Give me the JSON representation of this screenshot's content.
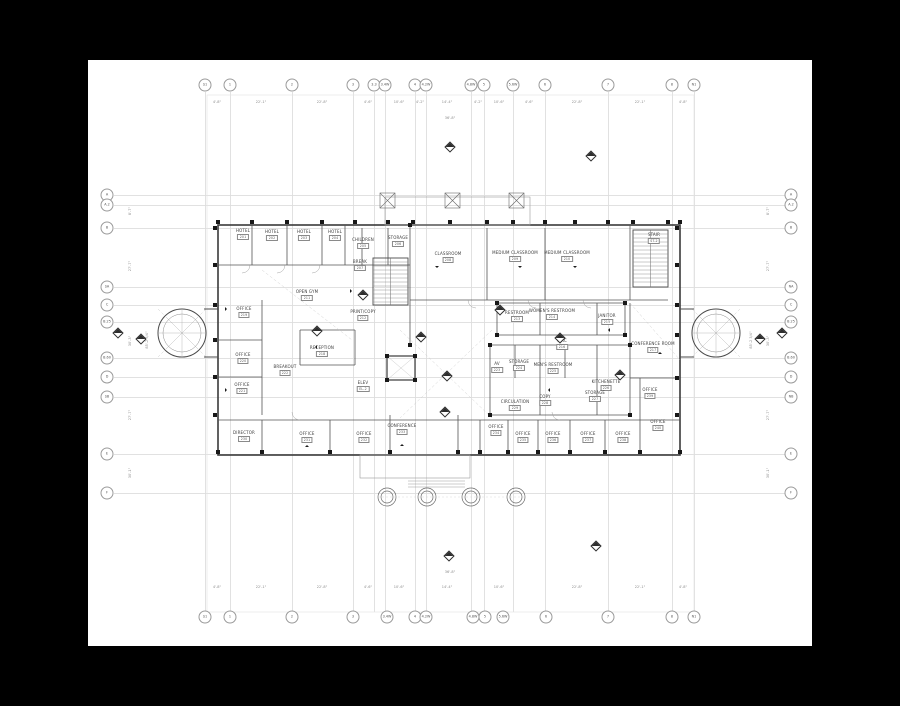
{
  "page": {
    "background": "#000000",
    "paper_color": "#ffffff",
    "paper": {
      "x": 88,
      "y": 60,
      "w": 724,
      "h": 586
    },
    "line_colors": {
      "grid": "#dcdcdc",
      "wall": "#3a3a3a",
      "partition": "#555555",
      "light": "#999999"
    },
    "drawing_type_note": "second floor plan"
  },
  "grid": {
    "top_y": 85,
    "bottom_y": 617,
    "left_x": 107,
    "right_x": 791,
    "vline_top": 92,
    "vline_bottom": 612,
    "hline_left": 114,
    "hline_right": 786,
    "top": [
      {
        "label": "S1",
        "x": 205
      },
      {
        "label": "1",
        "x": 230
      },
      {
        "label": "2",
        "x": 292
      },
      {
        "label": "3",
        "x": 353
      },
      {
        "label": "3.3",
        "x": 374
      },
      {
        "label": "3.4W",
        "x": 385
      },
      {
        "label": "4",
        "x": 415
      },
      {
        "label": "4.2W",
        "x": 426
      },
      {
        "label": "4.8W",
        "x": 471
      },
      {
        "label": "5",
        "x": 484
      },
      {
        "label": "5.6W",
        "x": 513
      },
      {
        "label": "6",
        "x": 545
      },
      {
        "label": "7",
        "x": 608
      },
      {
        "label": "8",
        "x": 672
      },
      {
        "label": "N1",
        "x": 694
      }
    ],
    "bottom": [
      {
        "label": "S1",
        "x": 205
      },
      {
        "label": "1",
        "x": 230
      },
      {
        "label": "2",
        "x": 292
      },
      {
        "label": "3",
        "x": 353
      },
      {
        "label": "3.4W",
        "x": 387
      },
      {
        "label": "4",
        "x": 415
      },
      {
        "label": "4.2W",
        "x": 426
      },
      {
        "label": "4.8W",
        "x": 473
      },
      {
        "label": "5",
        "x": 485
      },
      {
        "label": "5.6W",
        "x": 503
      },
      {
        "label": "6",
        "x": 546
      },
      {
        "label": "7",
        "x": 608
      },
      {
        "label": "8",
        "x": 672
      },
      {
        "label": "N1",
        "x": 694
      }
    ],
    "left": [
      {
        "label": "A",
        "y": 195
      },
      {
        "label": "A.2",
        "y": 205
      },
      {
        "label": "B",
        "y": 228
      },
      {
        "label": "SA",
        "y": 287
      },
      {
        "label": "C",
        "y": 305
      },
      {
        "label": "B.25",
        "y": 322
      },
      {
        "label": "B.60",
        "y": 358
      },
      {
        "label": "D",
        "y": 377
      },
      {
        "label": "SB",
        "y": 397
      },
      {
        "label": "E",
        "y": 454
      },
      {
        "label": "F",
        "y": 493
      }
    ],
    "right": [
      {
        "label": "A",
        "y": 195
      },
      {
        "label": "A.2",
        "y": 205
      },
      {
        "label": "B",
        "y": 228
      },
      {
        "label": "NA",
        "y": 287
      },
      {
        "label": "C",
        "y": 305
      },
      {
        "label": "B.25",
        "y": 322
      },
      {
        "label": "B.60",
        "y": 358
      },
      {
        "label": "D",
        "y": 377
      },
      {
        "label": "NB",
        "y": 397
      },
      {
        "label": "E",
        "y": 454
      },
      {
        "label": "F",
        "y": 493
      }
    ]
  },
  "rooms": [
    {
      "label": "HOTEL",
      "num": "201",
      "x": 243,
      "y": 229
    },
    {
      "label": "HOTEL",
      "num": "202",
      "x": 272,
      "y": 230
    },
    {
      "label": "HOTEL",
      "num": "203",
      "x": 304,
      "y": 230
    },
    {
      "label": "HOTEL",
      "num": "204",
      "x": 335,
      "y": 230
    },
    {
      "label": "CHILDREN",
      "num": "205",
      "x": 363,
      "y": 238
    },
    {
      "label": "STORAGE",
      "num": "206",
      "x": 398,
      "y": 236
    },
    {
      "label": "BREAK",
      "num": "207",
      "x": 360,
      "y": 260
    },
    {
      "label": "CLASSROOM",
      "num": "208",
      "x": 448,
      "y": 252
    },
    {
      "label": "MEDIUM CLASSROOM",
      "num": "209",
      "x": 515,
      "y": 251
    },
    {
      "label": "MEDIUM CLASSROOM",
      "num": "210",
      "x": 567,
      "y": 251
    },
    {
      "label": "STAIR",
      "num": "ST-2",
      "x": 654,
      "y": 233
    },
    {
      "label": "OPEN GYM",
      "num": "211",
      "x": 307,
      "y": 290
    },
    {
      "label": "PRINT/COPY",
      "num": "212",
      "x": 363,
      "y": 310
    },
    {
      "label": "RESTROOM",
      "num": "213",
      "x": 517,
      "y": 311
    },
    {
      "label": "WOMEN'S RESTROOM",
      "num": "214",
      "x": 552,
      "y": 309
    },
    {
      "label": "JANITOR",
      "num": "215",
      "x": 607,
      "y": 314
    },
    {
      "label": "CIRC",
      "num": "216",
      "x": 562,
      "y": 339
    },
    {
      "label": "CONFERENCE ROOM",
      "num": "217",
      "x": 653,
      "y": 342
    },
    {
      "label": "RECEPTION",
      "num": "218",
      "x": 322,
      "y": 346
    },
    {
      "label": "OFFICE",
      "num": "219",
      "x": 244,
      "y": 307
    },
    {
      "label": "OFFICE",
      "num": "220",
      "x": 243,
      "y": 353
    },
    {
      "label": "OFFICE",
      "num": "221",
      "x": 242,
      "y": 383
    },
    {
      "label": "BREAKOUT",
      "num": "222",
      "x": 285,
      "y": 365
    },
    {
      "label": "ELEV",
      "num": "EL-2",
      "x": 363,
      "y": 381
    },
    {
      "label": "AV",
      "num": "223",
      "x": 497,
      "y": 362
    },
    {
      "label": "STORAGE",
      "num": "224",
      "x": 519,
      "y": 360
    },
    {
      "label": "MEN'S RESTROOM",
      "num": "225",
      "x": 553,
      "y": 363
    },
    {
      "label": "KITCHENETTE",
      "num": "226",
      "x": 606,
      "y": 380
    },
    {
      "label": "STORAGE",
      "num": "227",
      "x": 595,
      "y": 391
    },
    {
      "label": "COPY",
      "num": "228",
      "x": 545,
      "y": 395
    },
    {
      "label": "CIRCULATION",
      "num": "229",
      "x": 515,
      "y": 400
    },
    {
      "label": "DIRECTOR",
      "num": "230",
      "x": 244,
      "y": 431
    },
    {
      "label": "OFFICE",
      "num": "231",
      "x": 307,
      "y": 432
    },
    {
      "label": "OFFICE",
      "num": "232",
      "x": 364,
      "y": 432
    },
    {
      "label": "CONFERENCE",
      "num": "233",
      "x": 402,
      "y": 424
    },
    {
      "label": "OFFICE",
      "num": "234",
      "x": 496,
      "y": 425
    },
    {
      "label": "OFFICE",
      "num": "235",
      "x": 523,
      "y": 432
    },
    {
      "label": "OFFICE",
      "num": "236",
      "x": 553,
      "y": 432
    },
    {
      "label": "OFFICE",
      "num": "237",
      "x": 588,
      "y": 432
    },
    {
      "label": "OFFICE",
      "num": "238",
      "x": 623,
      "y": 432
    },
    {
      "label": "OFFICE",
      "num": "239",
      "x": 650,
      "y": 388
    },
    {
      "label": "OFFICE",
      "num": "240",
      "x": 658,
      "y": 420
    }
  ],
  "dims": {
    "top": [
      {
        "t": "4'-8\"",
        "x": 217,
        "y": 100
      },
      {
        "t": "22'-1\"",
        "x": 261,
        "y": 100
      },
      {
        "t": "22'-8\"",
        "x": 322,
        "y": 100
      },
      {
        "t": "4'-6\"",
        "x": 368,
        "y": 100
      },
      {
        "t": "10'-6\"",
        "x": 399,
        "y": 100
      },
      {
        "t": "4'-2\"",
        "x": 420,
        "y": 100
      },
      {
        "t": "14'-4\"",
        "x": 447,
        "y": 100
      },
      {
        "t": "4'-2\"",
        "x": 478,
        "y": 100
      },
      {
        "t": "10'-6\"",
        "x": 499,
        "y": 100
      },
      {
        "t": "4'-6\"",
        "x": 529,
        "y": 100
      },
      {
        "t": "22'-8\"",
        "x": 577,
        "y": 100
      },
      {
        "t": "22'-1\"",
        "x": 640,
        "y": 100
      },
      {
        "t": "4'-8\"",
        "x": 683,
        "y": 100
      }
    ],
    "bottom": [
      {
        "t": "4'-8\"",
        "x": 217,
        "y": 585
      },
      {
        "t": "22'-1\"",
        "x": 261,
        "y": 585
      },
      {
        "t": "22'-8\"",
        "x": 322,
        "y": 585
      },
      {
        "t": "4'-6\"",
        "x": 368,
        "y": 585
      },
      {
        "t": "10'-6\"",
        "x": 399,
        "y": 585
      },
      {
        "t": "14'-4\"",
        "x": 447,
        "y": 585
      },
      {
        "t": "10'-6\"",
        "x": 499,
        "y": 585
      },
      {
        "t": "22'-8\"",
        "x": 577,
        "y": 585
      },
      {
        "t": "22'-1\"",
        "x": 640,
        "y": 585
      },
      {
        "t": "4'-8\"",
        "x": 683,
        "y": 585
      }
    ],
    "left": [
      {
        "t": "8'-7\"",
        "x": 130,
        "y": 211
      },
      {
        "t": "27'-7\"",
        "x": 130,
        "y": 266
      },
      {
        "t": "30'-3\"",
        "x": 130,
        "y": 341
      },
      {
        "t": "27'-7\"",
        "x": 130,
        "y": 415
      },
      {
        "t": "30'-1\"",
        "x": 130,
        "y": 473
      },
      {
        "t": "85'-2 3/4\"",
        "x": 147,
        "y": 340
      }
    ],
    "right": [
      {
        "t": "8'-7\"",
        "x": 768,
        "y": 211
      },
      {
        "t": "27'-7\"",
        "x": 768,
        "y": 266
      },
      {
        "t": "30'-3\"",
        "x": 768,
        "y": 341
      },
      {
        "t": "27'-7\"",
        "x": 768,
        "y": 415
      },
      {
        "t": "30'-1\"",
        "x": 768,
        "y": 473
      },
      {
        "t": "85'-2 3/4\"",
        "x": 751,
        "y": 340
      }
    ],
    "extra": [
      {
        "t": "36'-8\"",
        "x": 450,
        "y": 116
      },
      {
        "t": "36'-8\"",
        "x": 450,
        "y": 570
      }
    ]
  },
  "section_markers": [
    [
      450,
      147
    ],
    [
      591,
      156
    ],
    [
      449,
      556
    ],
    [
      596,
      546
    ],
    [
      118,
      333
    ],
    [
      141,
      339
    ],
    [
      782,
      333
    ],
    [
      760,
      339
    ],
    [
      421,
      337
    ],
    [
      447,
      376
    ],
    [
      317,
      331
    ],
    [
      560,
      338
    ],
    [
      445,
      412
    ],
    [
      500,
      310
    ],
    [
      363,
      295
    ],
    [
      620,
      375
    ]
  ],
  "columns": [
    [
      218,
      222
    ],
    [
      252,
      222
    ],
    [
      287,
      222
    ],
    [
      322,
      222
    ],
    [
      355,
      222
    ],
    [
      388,
      222
    ],
    [
      413,
      222
    ],
    [
      450,
      222
    ],
    [
      487,
      222
    ],
    [
      513,
      222
    ],
    [
      545,
      222
    ],
    [
      575,
      222
    ],
    [
      608,
      222
    ],
    [
      633,
      222
    ],
    [
      668,
      222
    ],
    [
      680,
      222
    ],
    [
      218,
      452
    ],
    [
      262,
      452
    ],
    [
      330,
      452
    ],
    [
      390,
      452
    ],
    [
      458,
      452
    ],
    [
      480,
      452
    ],
    [
      508,
      452
    ],
    [
      538,
      452
    ],
    [
      570,
      452
    ],
    [
      605,
      452
    ],
    [
      640,
      452
    ],
    [
      680,
      452
    ],
    [
      215,
      228
    ],
    [
      215,
      265
    ],
    [
      215,
      305
    ],
    [
      215,
      340
    ],
    [
      215,
      377
    ],
    [
      215,
      415
    ],
    [
      677,
      228
    ],
    [
      677,
      265
    ],
    [
      677,
      305
    ],
    [
      677,
      335
    ],
    [
      677,
      378
    ],
    [
      677,
      415
    ],
    [
      497,
      303
    ],
    [
      625,
      303
    ],
    [
      497,
      335
    ],
    [
      625,
      335
    ],
    [
      490,
      345
    ],
    [
      630,
      345
    ],
    [
      490,
      415
    ],
    [
      630,
      415
    ],
    [
      387,
      356
    ],
    [
      415,
      356
    ],
    [
      387,
      380
    ],
    [
      415,
      380
    ],
    [
      410,
      225
    ],
    [
      410,
      345
    ]
  ],
  "door_triangles": [
    [
      352,
      291,
      "r"
    ],
    [
      315,
      347,
      "l"
    ],
    [
      227,
      309,
      "r"
    ],
    [
      227,
      390,
      "r"
    ],
    [
      437,
      268,
      "d"
    ],
    [
      520,
      268,
      "d"
    ],
    [
      575,
      268,
      "d"
    ],
    [
      608,
      330,
      "l"
    ],
    [
      548,
      390,
      "l"
    ],
    [
      660,
      352,
      "u"
    ],
    [
      402,
      444,
      "u"
    ],
    [
      307,
      445,
      "u"
    ]
  ]
}
